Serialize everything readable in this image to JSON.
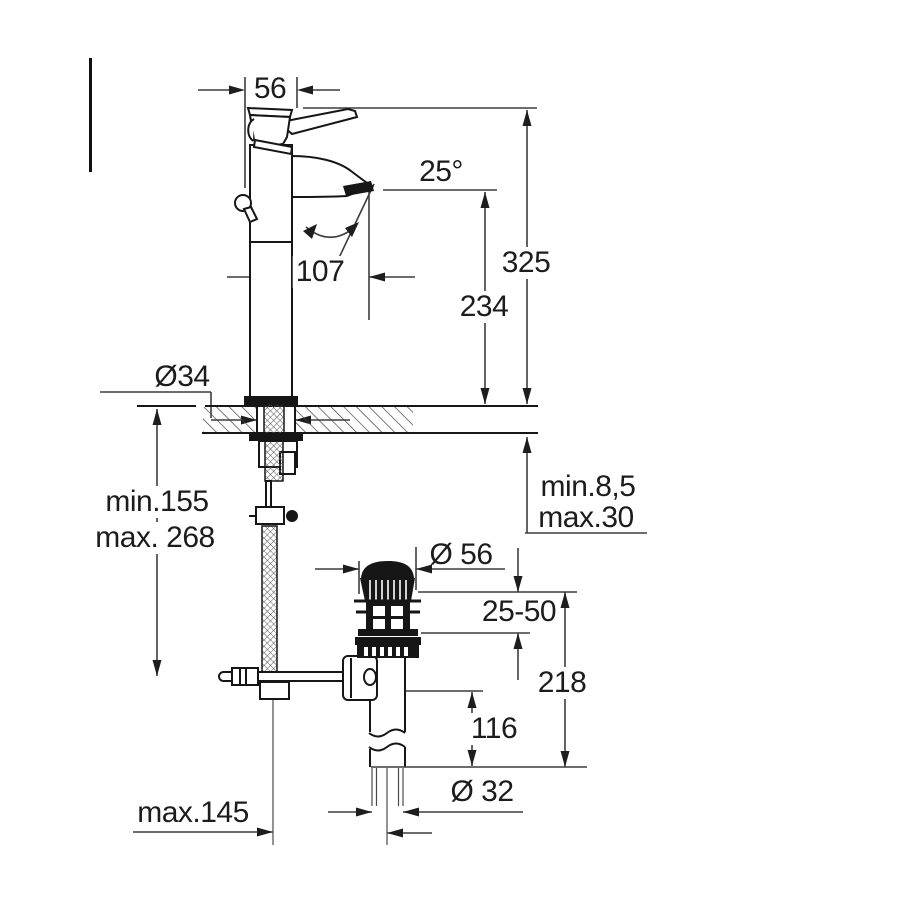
{
  "drawing": {
    "kind": "technical-dimension-diagram",
    "line_color": "#1c1c1c",
    "background_color": "#ffffff",
    "labels": {
      "width_top": "56",
      "spout_angle": "25°",
      "height_overall": "325",
      "spout_projection": "107",
      "spout_height": "234",
      "hole_diameter": "Ø34",
      "hose_length_min": "min.155",
      "hose_length_max": "max. 268",
      "deck_thickness_min": "min.8,5",
      "deck_thickness_max": "max.30",
      "waste_flange_diameter": "Ø 56",
      "basin_clamp_range": "25-50",
      "waste_height": "218",
      "tailpipe_length": "116",
      "tailpipe_diameter": "Ø 32",
      "rod_reach_max": "max.145"
    }
  }
}
